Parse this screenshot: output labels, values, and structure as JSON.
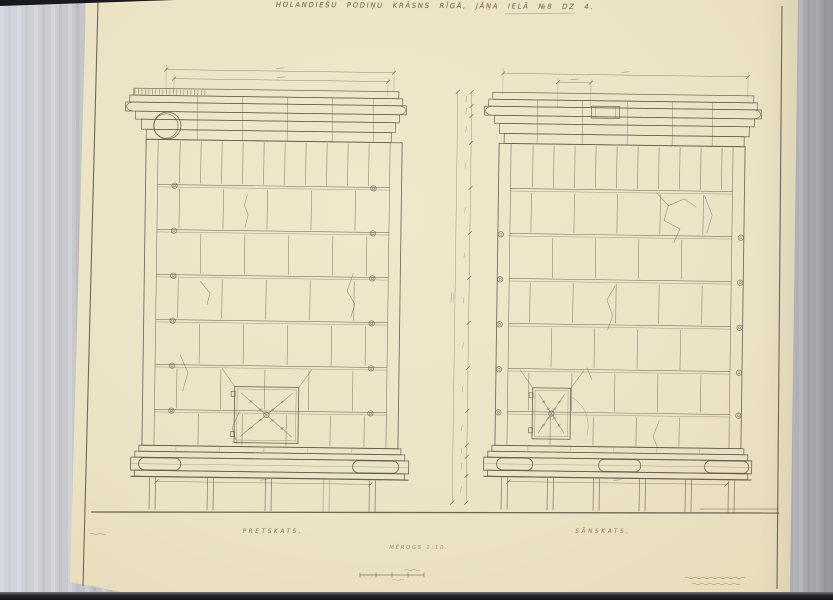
{
  "sheet": {
    "title": "HOLANDIEŠU PODIŅU KRĀSNS RĪGĀ, JĀŅA IELĀ №8 DZ 4.",
    "left_view_label": "PRETSKATS.",
    "right_view_label": "SĀNSKATS.",
    "scale_label": "MĒROGS 1:10."
  },
  "colors": {
    "paper": "#ece3c5",
    "ink": "#5f5c4d",
    "title_ink": "#6d6049",
    "note_ink": "#7b5a42",
    "backdrop": "#c2c3c7",
    "edge_bar": "#1b1b1f"
  }
}
